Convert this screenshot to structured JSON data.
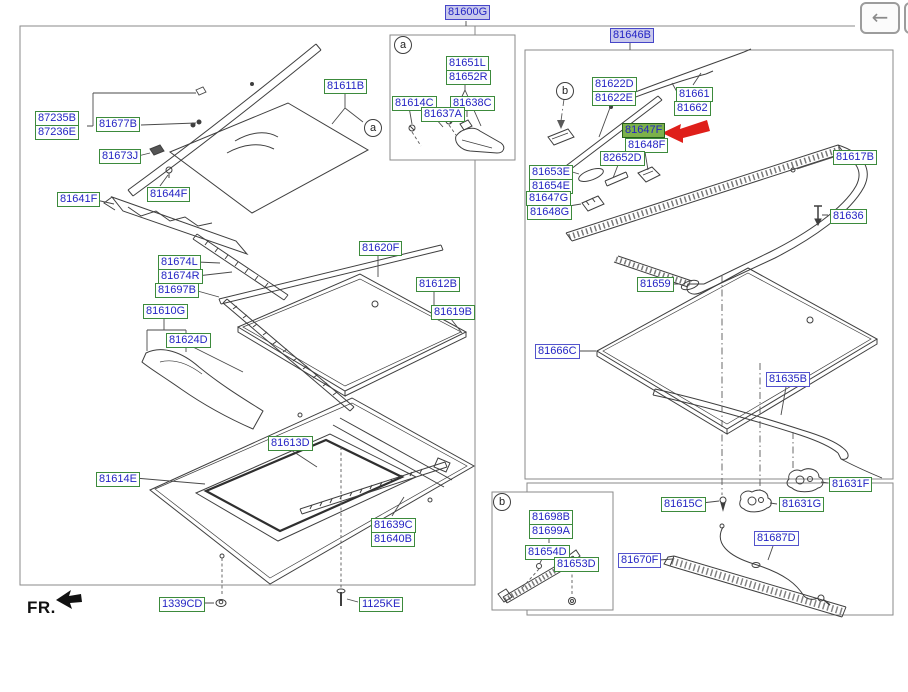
{
  "window": {
    "back_icon": "←"
  },
  "diagram": {
    "title_part": "81600G",
    "selected_part": "81647F",
    "fr_label": "FR.",
    "markers": {
      "a": "a",
      "b": "b"
    },
    "colors": {
      "label_text": "#2424c4",
      "green_border": "#3c8a3c",
      "blue_border": "#5353cc",
      "selected_fill": "#7cb14a",
      "assembly_fill": "#c9c9ec",
      "arrow_red": "#df1f1a"
    },
    "parts": {
      "81600G": "81600G",
      "87235B": "87235B",
      "87236E": "87236E",
      "81677B": "81677B",
      "81673J": "81673J",
      "81644F": "81644F",
      "81641F": "81641F",
      "81611B": "81611B",
      "81674L": "81674L",
      "81674R": "81674R",
      "81697B": "81697B",
      "81610G": "81610G",
      "81624D": "81624D",
      "81620F": "81620F",
      "81612B": "81612B",
      "81619B": "81619B",
      "81613D": "81613D",
      "81614E": "81614E",
      "81639C": "81639C",
      "81640B": "81640B",
      "1339CD": "1339CD",
      "1125KE": "1125KE",
      "81651L": "81651L",
      "81652R": "81652R",
      "81614C": "81614C",
      "81638C": "81638C",
      "81637A": "81637A",
      "81646B": "81646B",
      "81622D": "81622D",
      "81622E": "81622E",
      "81661": "81661",
      "81662": "81662",
      "81647F": "81647F",
      "81648F": "81648F",
      "82652D": "82652D",
      "81653E": "81653E",
      "81654E": "81654E",
      "81647G": "81647G",
      "81648G": "81648G",
      "81617B": "81617B",
      "81636": "81636",
      "81659": "81659",
      "81666C": "81666C",
      "81635B": "81635B",
      "81631F": "81631F",
      "81615C": "81615C",
      "81631G": "81631G",
      "81687D": "81687D",
      "81670F": "81670F",
      "81698B": "81698B",
      "81699A": "81699A",
      "81654D": "81654D",
      "81653D": "81653D"
    }
  }
}
